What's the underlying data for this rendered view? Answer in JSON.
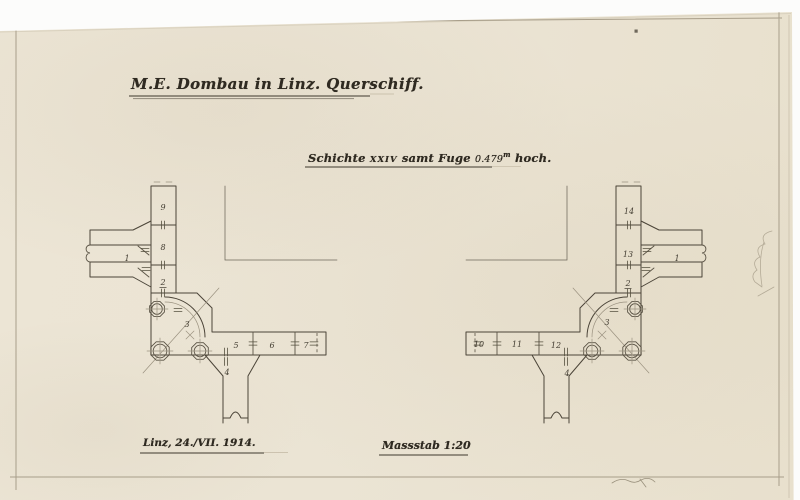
{
  "title_block": {
    "title": "M.E. Dombau in Linz. Querschiff."
  },
  "subtitle_block": {
    "prefix": "Schichte",
    "course_numeral": "XXIV",
    "middle": "samt Fuge",
    "height_value": "0.479",
    "height_unit": "m",
    "suffix": "hoch."
  },
  "footer": {
    "place_date": "Linz, 24./VII. 1914.",
    "scale_word": "Massstab",
    "scale_ratio": "1:20"
  },
  "left_plan": {
    "stone_labels": [
      {
        "text": "9",
        "x": 163,
        "y": 210
      },
      {
        "text": "8",
        "x": 163,
        "y": 250
      },
      {
        "text": "2",
        "x": 163,
        "y": 285,
        "underline": true
      },
      {
        "text": "1",
        "x": 127,
        "y": 261
      },
      {
        "text": "3",
        "x": 187,
        "y": 327
      },
      {
        "text": "5",
        "x": 236,
        "y": 348
      },
      {
        "text": "6",
        "x": 272,
        "y": 348
      },
      {
        "text": "7",
        "x": 306,
        "y": 348
      },
      {
        "text": "4",
        "x": 227,
        "y": 375
      }
    ]
  },
  "right_plan": {
    "stone_labels": [
      {
        "text": "14",
        "x": 629,
        "y": 214
      },
      {
        "text": "13",
        "x": 628,
        "y": 257
      },
      {
        "text": "2",
        "x": 628,
        "y": 286,
        "underline": true
      },
      {
        "text": "1",
        "x": 677,
        "y": 261
      },
      {
        "text": "3",
        "x": 607,
        "y": 325
      },
      {
        "text": "10",
        "x": 479,
        "y": 347
      },
      {
        "text": "11",
        "x": 517,
        "y": 347
      },
      {
        "text": "12",
        "x": 556,
        "y": 348
      },
      {
        "text": "4",
        "x": 567,
        "y": 376
      }
    ]
  },
  "colors": {
    "paper": "#ebe4d4",
    "ink": "#2f2a21",
    "drawing_line": "#4b4438",
    "faint_line": "#9b9280",
    "pencil": "#b4ab97"
  }
}
